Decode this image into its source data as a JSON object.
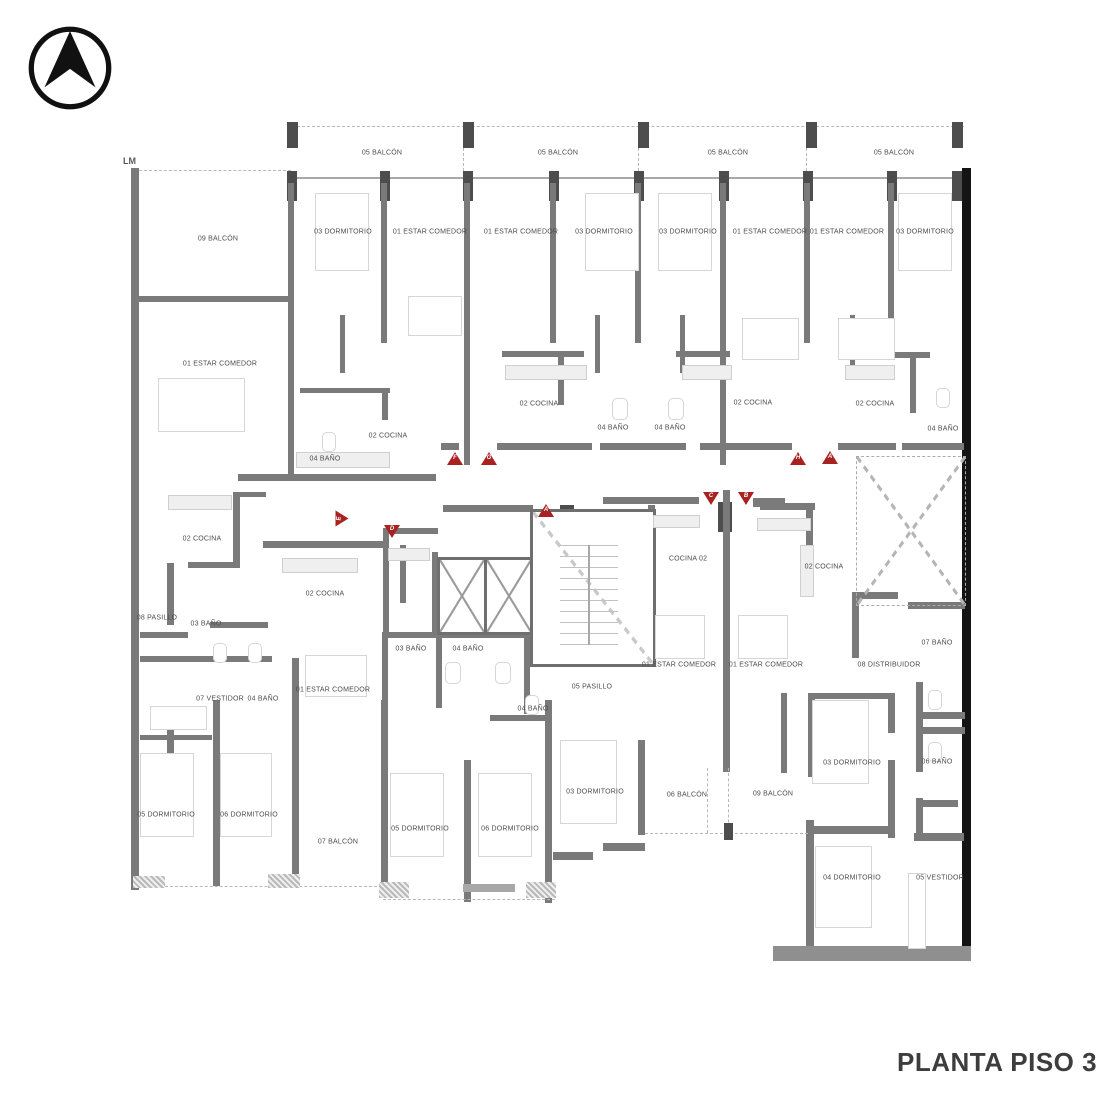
{
  "title": "PLANTA PISO 3",
  "boundary_label": "LM",
  "icons": {
    "compass": "north-arrow-icon"
  },
  "colors": {
    "marker_red": "#a92222",
    "wall_gray": "#7a7a7a",
    "wall_black": "#141414",
    "title_gray": "#3d3d3d"
  },
  "rooms": [
    {
      "label": "05 BALCÓN"
    },
    {
      "label": "05 BALCÓN"
    },
    {
      "label": "05 BALCÓN"
    },
    {
      "label": "05 BALCÓN"
    },
    {
      "label": "09 BALCÓN"
    },
    {
      "label": "03 DORMITORIO"
    },
    {
      "label": "01 ESTAR COMEDOR"
    },
    {
      "label": "01 ESTAR COMEDOR"
    },
    {
      "label": "03 DORMITORIO"
    },
    {
      "label": "03 DORMITORIO"
    },
    {
      "label": "01 ESTAR COMEDOR"
    },
    {
      "label": "01 ESTAR COMEDOR"
    },
    {
      "label": "03 DORMITORIO"
    },
    {
      "label": "01 ESTAR COMEDOR"
    },
    {
      "label": "02 COCINA"
    },
    {
      "label": "04 BAÑO"
    },
    {
      "label": "02 COCINA"
    },
    {
      "label": "04 BAÑO"
    },
    {
      "label": "04 BAÑO"
    },
    {
      "label": "02 COCINA"
    },
    {
      "label": "02 COCINA"
    },
    {
      "label": "04 BAÑO"
    },
    {
      "label": "02 COCINA"
    },
    {
      "label": "02 COCINA"
    },
    {
      "label": "COCINA 02"
    },
    {
      "label": "02 COCINA"
    },
    {
      "label": "08 PASILLO"
    },
    {
      "label": "03 BAÑO"
    },
    {
      "label": "03 BAÑO"
    },
    {
      "label": "04 BAÑO"
    },
    {
      "label": "01 ESTAR COMEDOR"
    },
    {
      "label": "01 ESTAR COMEDOR"
    },
    {
      "label": "08 DISTRIBUIDOR"
    },
    {
      "label": "07 BAÑO"
    },
    {
      "label": "07 VESTIDOR"
    },
    {
      "label": "04 BAÑO"
    },
    {
      "label": "01 ESTAR COMEDOR"
    },
    {
      "label": "05 PASILLO"
    },
    {
      "label": "04 BAÑO"
    },
    {
      "label": "06 BAÑO"
    },
    {
      "label": "05 DORMITORIO"
    },
    {
      "label": "06 DORMITORIO"
    },
    {
      "label": "07 BALCÓN"
    },
    {
      "label": "05 DORMITORIO"
    },
    {
      "label": "06 DORMITORIO"
    },
    {
      "label": "03 DORMITORIO"
    },
    {
      "label": "06 BALCÓN"
    },
    {
      "label": "09 BALCÓN"
    },
    {
      "label": "03 DORMITORIO"
    },
    {
      "label": "04 DORMITORIO"
    },
    {
      "label": "05 VESTIDOR"
    }
  ],
  "markers": [
    {
      "letter": "F"
    },
    {
      "letter": "G"
    },
    {
      "letter": "H"
    },
    {
      "letter": "A"
    },
    {
      "letter": "A"
    },
    {
      "letter": "D"
    },
    {
      "letter": "C"
    },
    {
      "letter": "B"
    },
    {
      "letter": "E"
    }
  ]
}
